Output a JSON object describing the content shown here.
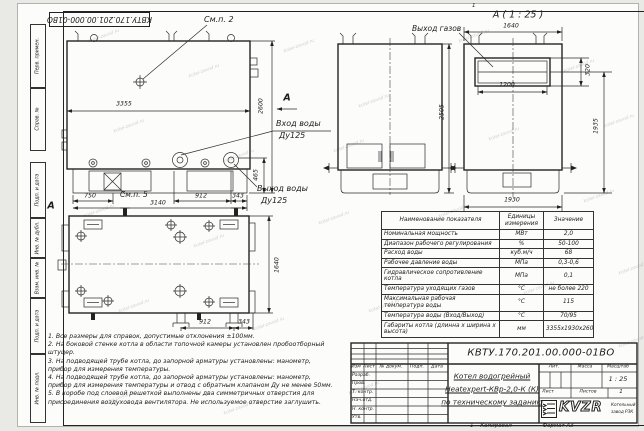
{
  "watermark": {
    "text": "kotel-zavod.ru"
  },
  "frame": {
    "stamp_top": "КВТУ.170.201.00.000-01ВО",
    "margin_top": [
      "Перв. примен.",
      "Справ. №"
    ],
    "margin_bottom": [
      "Подп. и дата",
      "Инв. № дубл.",
      "Взам. инв. №",
      "Подп. и дата",
      "Инв. № подл."
    ],
    "top_mark": "1",
    "bottom_mark": "1",
    "copied_label": "Копировал",
    "format_label": "Формат А3"
  },
  "views": {
    "front": {
      "callout_top": "См.п. 2",
      "callout_bottom": "См.п. 5",
      "section_label": "А",
      "water_in_line1": "Вход воды",
      "water_in_line2": "Ду125",
      "water_out_line1": "Выход воды",
      "water_out_line2": "Ду125",
      "dim_width": "3355",
      "dim_height": "2600",
      "dim_465": "465",
      "dim_750": "750",
      "dim_3140": "3140",
      "dim_912": "912",
      "dim_343": "343"
    },
    "side": {
      "dim_height": "2505"
    },
    "detail": {
      "title": "А ( 1 : 25 )",
      "gas_label": "Выход газов",
      "dim_1640": "1640",
      "dim_1200": "1200",
      "dim_320": "320",
      "dim_1935": "1935",
      "dim_1930": "1930"
    },
    "plan": {
      "view_label": "А",
      "dim_1640": "1640",
      "dim_912": "912",
      "dim_343": "343"
    }
  },
  "table": {
    "headers": {
      "name": "Наименование показателя",
      "unit": "Единицы измерения",
      "value": "Значение"
    },
    "rows": [
      {
        "name": "Номинальная мощность",
        "unit": "МВт",
        "value": "2,0"
      },
      {
        "name": "Диапазон рабочего регулирования",
        "unit": "%",
        "value": "50-100"
      },
      {
        "name": "Расход воды",
        "unit": "куб.м/ч",
        "value": "68"
      },
      {
        "name": "Рабочее давление воды",
        "unit": "МПа",
        "value": "0,3-0,6"
      },
      {
        "name": "Гидравлическое сопротивление котла",
        "unit": "МПа",
        "value": "0,1"
      },
      {
        "name": "Температура уходящих газов",
        "unit": "°С",
        "value": "не более 220"
      },
      {
        "name": "Максимальная рабочая температура воды",
        "unit": "°С",
        "value": "115"
      },
      {
        "name": "Температура воды (Вход/Выход)",
        "unit": "°С",
        "value": "70/95"
      },
      {
        "name": "Габариты котла (длинна х ширина х высота)",
        "unit": "мм",
        "value": "3355х1930х2600"
      }
    ]
  },
  "notes": [
    "1. Все размеры для справок, допустимые отклонения ±100мм.",
    "2. На боковой стенке котла в области топочной камеры установлен пробоотборный штуцер.",
    "3. На подводящей трубе котла, до запорной арматуры установлены: манометр, прибор для измерения температуры.",
    "4. На подводящей трубе котла, до запорной арматуры установлены: манометр, прибор для измерения температуры и отвод с обратным клапаном Ду не менее 50мм.",
    "5. В коробе под слоевой решеткой выполнены два симметричных отверстия для присоединения воздуховода вентилятора. Не используемое отверстие заглушить."
  ],
  "title_block": {
    "doc_number": "КВТУ.170.201.00.000-01ВО",
    "product_line1": "Котел водогрейный",
    "product_line2": "Heatexpert-КВр-2,0-К (К)",
    "product_line3": "по техническому заданию",
    "cols": {
      "izm": "Изм",
      "list": "Лист",
      "docnum": "№ докум.",
      "podp": "Подп.",
      "data": "Дата"
    },
    "sign_rows": [
      "Разраб.",
      "Пров.",
      "Т. контр.",
      "Нач.отд.",
      "Н. контр.",
      "Утв."
    ],
    "lit_label": "Лит.",
    "mass_label": "Масса",
    "scale_label": "Масштаб",
    "scale_value": "1 : 25",
    "sheet_label": "Лист",
    "sheets_label": "Листов",
    "sheets_value": "1",
    "logo_text": "KVZR",
    "company_line1": "Котельный",
    "company_line2": "завод РЗК"
  }
}
